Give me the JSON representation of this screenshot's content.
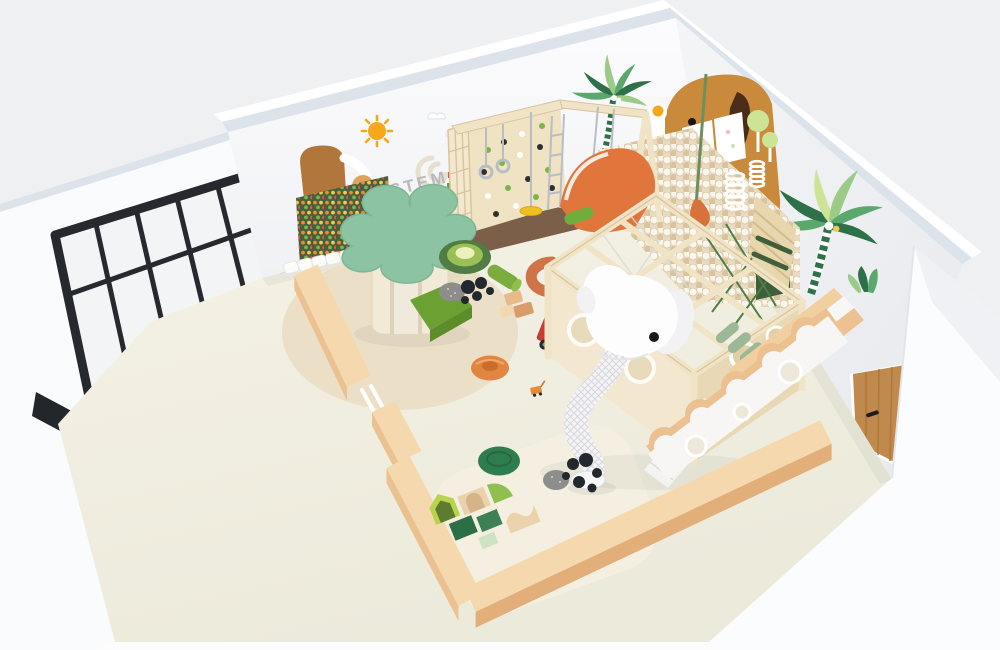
{
  "scene": {
    "wall_text": "STEM",
    "colors": {
      "bg": "#eff0f2",
      "exterior": "#fbfcfd",
      "wall": "#fafbfd",
      "wallShade": "#edeff2",
      "wallEdge": "#dde3ea",
      "floor": "#f3f0e2",
      "floorDeep": "#ece8d8",
      "rug": "#ecdfc8",
      "rugLight": "#f4efe0",
      "frameBlack": "#26292e",
      "glass": "#f3f4f6",
      "peach": "#f6d8ae",
      "peachSide": "#ecc191",
      "peachDark": "#e2ae79",
      "birch": "#f1e4c6",
      "birchEdge": "#d9c49c",
      "panel": "#efe3c4",
      "panelShade": "#e6d6b2",
      "matBrown": "#7c5f49",
      "pegBoard": "#47603f",
      "pegOrange": "#f08c2e",
      "pegYellow": "#f2c94c",
      "pegRed": "#e05252",
      "pegGreen": "#7ab648",
      "stemText": "#b9b9bd",
      "canopy": "#8cc3a3",
      "canopyEdge": "#79b291",
      "grass": "#6da032",
      "grassDark": "#5d8c2a",
      "lime": "#b7d44c",
      "limeDark": "#8fbf4e",
      "darkGreen": "#2e7d4e",
      "foamGreen": "#2c6e45",
      "foamGreen2": "#3c8054",
      "foamBeige": "#ecd2ac",
      "foamMint": "#cde4c4",
      "slideOrange": "#e0763c",
      "donutOrange": "#e08640",
      "donutDeep": "#c96d2c",
      "elephantOrange": "#c98a3c",
      "earBrown": "#4a2d18",
      "decalBrown": "#b0763c",
      "sunOrange": "#f5a81c",
      "palmDark": "#2e7047",
      "palmMid": "#5aa86b",
      "palmLight": "#9ccb87",
      "palmPale": "#cde496",
      "truckRed": "#c63b33",
      "discYellow": "#f0c01f",
      "ballCream": "#faf6ec",
      "ballTan": "#d9c49e",
      "pitBase": "#e7dcc3",
      "rockGray": "#8d8d8b",
      "ballBlack": "#23272e",
      "doorWood": "#c08a4e",
      "doorGrain": "#a9762f",
      "white": "#fdfdfe",
      "stairWhite": "#f3f3f1",
      "ropeGray": "#b9bdc4",
      "netGreen": "#4e7d46",
      "sageRoller": "#9cb897",
      "swingGreen": "#6fae3c",
      "obstacleGreen": "#3e5e3c",
      "screenWhite": "#ffffff",
      "seatRingOuter": "#4f7d43",
      "seatRingMid": "#9abf55",
      "seatRingIn": "#eef0bc",
      "cSeat": "#cf7348"
    },
    "objects": [
      {
        "id": "glass-partition",
        "label": "black framed glass partition"
      },
      {
        "id": "sun-decal",
        "label": "sun wall decal"
      },
      {
        "id": "stem-wall",
        "label": "STEM activity wall"
      },
      {
        "id": "pegboard",
        "label": "green peg activity board"
      },
      {
        "id": "climbing-frame",
        "label": "wooden climbing frame with rings and swings"
      },
      {
        "id": "orange-slide-mound",
        "label": "orange toddler slide mound"
      },
      {
        "id": "palm-decal-back",
        "label": "palm tree decal on back wall"
      },
      {
        "id": "elephant-wall-panel",
        "label": "orange elephant wall panel with screens"
      },
      {
        "id": "ball-pit",
        "label": "white ball pit"
      },
      {
        "id": "punching-bag",
        "label": "orange punching bag"
      },
      {
        "id": "spiral-tubes",
        "label": "white spiral tubes"
      },
      {
        "id": "obstacle-bars",
        "label": "green obstacle wall bars"
      },
      {
        "id": "palm-decal-right",
        "label": "palm tree decal on right wall"
      },
      {
        "id": "piano-stairs",
        "label": "piano key stairs"
      },
      {
        "id": "play-structure",
        "label": "birch soft play structure"
      },
      {
        "id": "elephant-slide",
        "label": "white elephant spiral slide"
      },
      {
        "id": "white-staircase",
        "label": "white staircase"
      },
      {
        "id": "wavy-fence",
        "label": "wavy white fence with portholes"
      },
      {
        "id": "wooden-door",
        "label": "wooden door"
      },
      {
        "id": "tree-tower",
        "label": "tree tower with green canopy and slide"
      },
      {
        "id": "ring-seat",
        "label": "concentric ring floor seat"
      },
      {
        "id": "foam-blocks",
        "label": "soft foam block set"
      },
      {
        "id": "fire-truck",
        "label": "toy fire truck"
      },
      {
        "id": "toddler-benches",
        "label": "peach toddler corner benches with gate"
      },
      {
        "id": "round-rug",
        "label": "round beige rug"
      }
    ]
  }
}
